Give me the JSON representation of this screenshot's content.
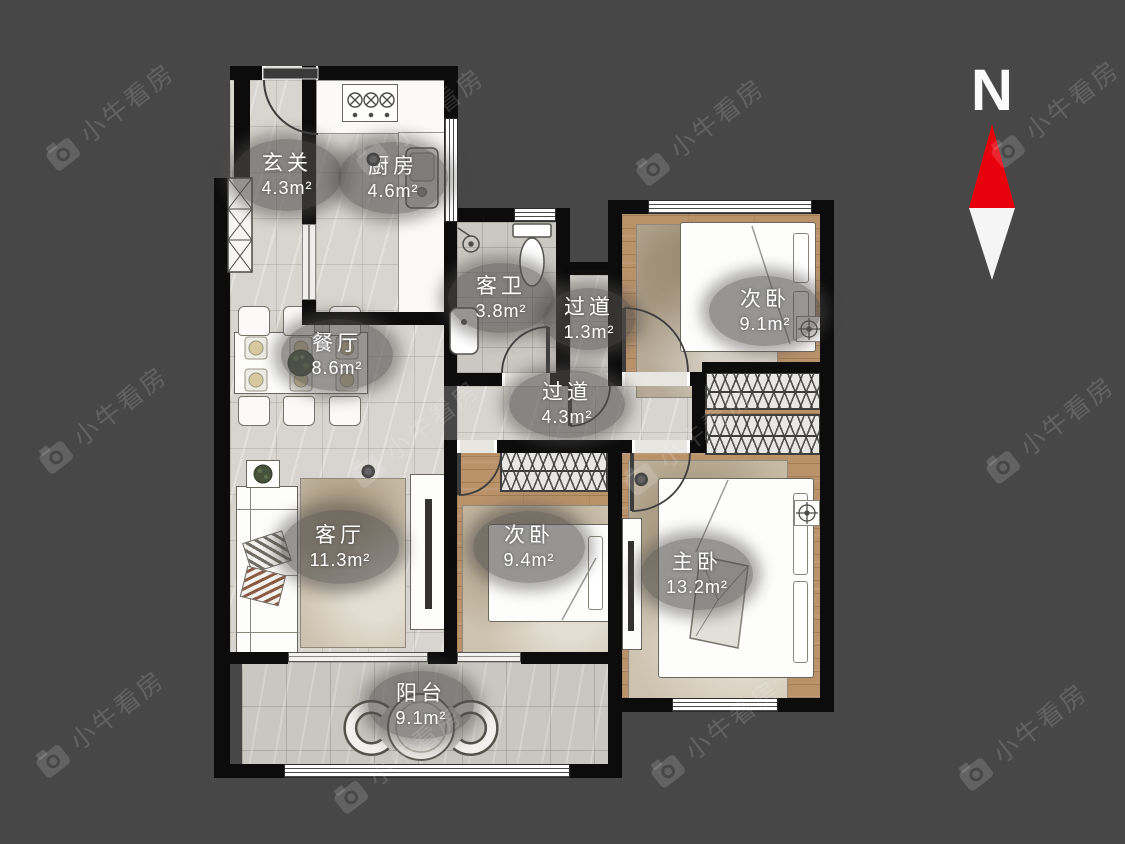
{
  "page": {
    "background": "#474747",
    "wall_color": "#0c0c0c"
  },
  "compass": {
    "label": "N",
    "needle_up_color": "#e8000d",
    "needle_down_color": "#f5f5f5"
  },
  "watermark": {
    "text": "小牛看房",
    "icon": "camera-icon"
  },
  "rooms": {
    "xuanguan": {
      "name": "玄关",
      "area": "4.3m²"
    },
    "chufang": {
      "name": "厨房",
      "area": "4.6m²"
    },
    "kewei": {
      "name": "客卫",
      "area": "3.8m²"
    },
    "guodao_small": {
      "name": "过道",
      "area": "1.3m²"
    },
    "ciwo_top": {
      "name": "次卧",
      "area": "9.1m²"
    },
    "canting": {
      "name": "餐厅",
      "area": "8.6m²"
    },
    "guodao_main": {
      "name": "过道",
      "area": "4.3m²"
    },
    "keting": {
      "name": "客厅",
      "area": "11.3m²"
    },
    "ciwo_mid": {
      "name": "次卧",
      "area": "9.4m²"
    },
    "zhuwo": {
      "name": "主卧",
      "area": "13.2m²"
    },
    "yangtai": {
      "name": "阳台",
      "area": "9.1m²"
    }
  },
  "icons": {
    "compass_needle": "north-arrow-icon",
    "watermark_logo": "camera-icon",
    "stove": "gas-stove-icon",
    "kitchen_sink": "sink-icon",
    "toilet": "toilet-icon",
    "shower": "shower-icon",
    "bath_sink": "washbasin-icon",
    "plant": "plant-icon",
    "ceiling_lamp": "lamp-crosshair-icon"
  }
}
